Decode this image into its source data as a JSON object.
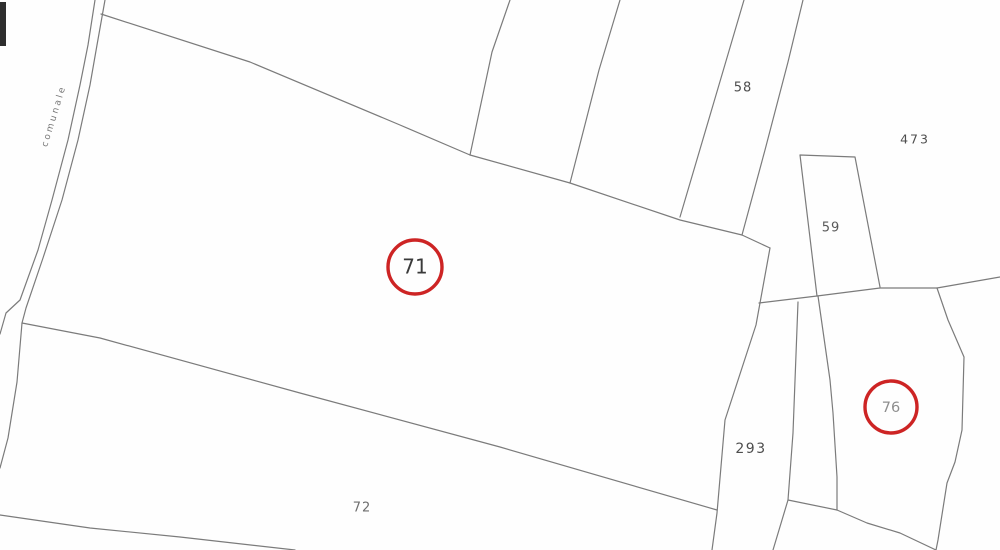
{
  "map": {
    "type": "cadastral-parcel-map",
    "background": "#fefefe",
    "line_color": "#7b7b7b",
    "line_width": 1.2,
    "highlight_color": "#cd2424",
    "road_label": {
      "text": "comunale",
      "x": 54,
      "y": 116,
      "rotation_deg": -73,
      "color": "#767676",
      "font_size": 9,
      "letter_spacing": 2.5
    },
    "corner_marker": {
      "x": 0,
      "y": 2,
      "width": 6,
      "height": 44,
      "color": "#2e2e2e"
    },
    "parcel_labels": [
      {
        "name": "parcel-label-58",
        "text": "58",
        "x": 743,
        "y": 88,
        "font_size": 13,
        "color": "#4e4e4e",
        "letter_spacing": 1
      },
      {
        "name": "parcel-label-473",
        "text": "473",
        "x": 915,
        "y": 140,
        "font_size": 12.5,
        "color": "#4e4e4e",
        "letter_spacing": 2
      },
      {
        "name": "parcel-label-59",
        "text": "59",
        "x": 831,
        "y": 228,
        "font_size": 13,
        "color": "#595959",
        "letter_spacing": 1
      },
      {
        "name": "parcel-label-293",
        "text": "293",
        "x": 751,
        "y": 449,
        "font_size": 14,
        "color": "#4e4e4e",
        "letter_spacing": 1.5
      },
      {
        "name": "parcel-label-72",
        "text": "72",
        "x": 362,
        "y": 508,
        "font_size": 13,
        "color": "#6e6e6e",
        "letter_spacing": 1
      }
    ],
    "highlighted_parcels": [
      {
        "name": "parcel-marker-71",
        "text": "71",
        "cx": 415,
        "cy": 267,
        "r": 27,
        "stroke_width": 3.4,
        "font_size": 20,
        "text_color": "#3a3a3a"
      },
      {
        "name": "parcel-marker-76",
        "text": "76",
        "cx": 891,
        "cy": 407,
        "r": 26,
        "stroke_width": 3.4,
        "font_size": 14.5,
        "text_color": "#8e8e8e"
      }
    ],
    "boundaries": [
      {
        "name": "road-west-line",
        "points": [
          [
            95,
            0
          ],
          [
            88,
            45
          ],
          [
            80,
            85
          ],
          [
            68,
            140
          ],
          [
            52,
            200
          ],
          [
            38,
            250
          ],
          [
            20,
            300
          ],
          [
            6,
            313
          ],
          [
            0,
            334
          ]
        ]
      },
      {
        "name": "road-east-line",
        "points": [
          [
            105,
            0
          ],
          [
            97,
            45
          ],
          [
            90,
            85
          ],
          [
            78,
            140
          ],
          [
            62,
            200
          ],
          [
            43,
            258
          ],
          [
            26,
            308
          ],
          [
            22,
            323
          ],
          [
            17,
            382
          ],
          [
            8,
            438
          ],
          [
            0,
            468
          ]
        ]
      },
      {
        "name": "parcel-71-north-boundary",
        "points": [
          [
            101,
            14
          ],
          [
            250,
            62
          ],
          [
            400,
            125
          ],
          [
            470,
            155
          ],
          [
            570,
            183
          ],
          [
            680,
            220
          ],
          [
            742,
            235
          ],
          [
            770,
            248
          ]
        ]
      },
      {
        "name": "top-fan-line-1",
        "points": [
          [
            510,
            0
          ],
          [
            492,
            52
          ],
          [
            470,
            155
          ]
        ]
      },
      {
        "name": "top-fan-line-2",
        "points": [
          [
            620,
            0
          ],
          [
            599,
            70
          ],
          [
            570,
            183
          ]
        ]
      },
      {
        "name": "parcel-58-west-boundary",
        "points": [
          [
            744,
            0
          ],
          [
            716,
            95
          ],
          [
            680,
            217
          ]
        ]
      },
      {
        "name": "parcel-58-east-boundary",
        "points": [
          [
            803,
            0
          ],
          [
            788,
            62
          ],
          [
            765,
            150
          ],
          [
            742,
            235
          ]
        ]
      },
      {
        "name": "parcel-293-west-boundary",
        "points": [
          [
            770,
            248
          ],
          [
            756,
            325
          ],
          [
            725,
            420
          ],
          [
            717,
            513
          ],
          [
            712,
            550
          ]
        ]
      },
      {
        "name": "parcel-71-72-boundary",
        "points": [
          [
            22,
            323
          ],
          [
            100,
            338
          ],
          [
            300,
            393
          ],
          [
            500,
            447
          ],
          [
            717,
            510
          ]
        ]
      },
      {
        "name": "parcel-72-south-boundary",
        "points": [
          [
            0,
            515
          ],
          [
            90,
            528
          ],
          [
            180,
            537
          ],
          [
            295,
            550
          ]
        ]
      },
      {
        "name": "parcel-293-east-boundary",
        "points": [
          [
            798,
            302
          ],
          [
            793,
            433
          ],
          [
            788,
            500
          ],
          [
            773,
            550
          ]
        ]
      },
      {
        "name": "parcel-293-76-link",
        "points": [
          [
            788,
            500
          ],
          [
            837,
            510
          ]
        ]
      },
      {
        "name": "parcel-59-outline",
        "points": [
          [
            817,
            296
          ],
          [
            800,
            155
          ],
          [
            855,
            157
          ],
          [
            880,
            287
          ]
        ]
      },
      {
        "name": "east-horizontal-boundary",
        "points": [
          [
            759,
            303
          ],
          [
            817,
            296
          ],
          [
            880,
            288
          ],
          [
            937,
            288
          ],
          [
            1000,
            277
          ]
        ]
      },
      {
        "name": "parcel-76-west-boundary",
        "points": [
          [
            818,
            296
          ],
          [
            830,
            380
          ],
          [
            833,
            413
          ],
          [
            837,
            477
          ],
          [
            837,
            510
          ]
        ]
      },
      {
        "name": "parcel-76-south-boundary",
        "points": [
          [
            837,
            510
          ],
          [
            867,
            523
          ],
          [
            900,
            533
          ],
          [
            936,
            550
          ]
        ]
      },
      {
        "name": "parcel-76-east-boundary",
        "points": [
          [
            937,
            288
          ],
          [
            948,
            320
          ],
          [
            964,
            357
          ],
          [
            962,
            430
          ],
          [
            955,
            462
          ],
          [
            947,
            483
          ],
          [
            938,
            540
          ],
          [
            936,
            550
          ]
        ]
      }
    ]
  }
}
